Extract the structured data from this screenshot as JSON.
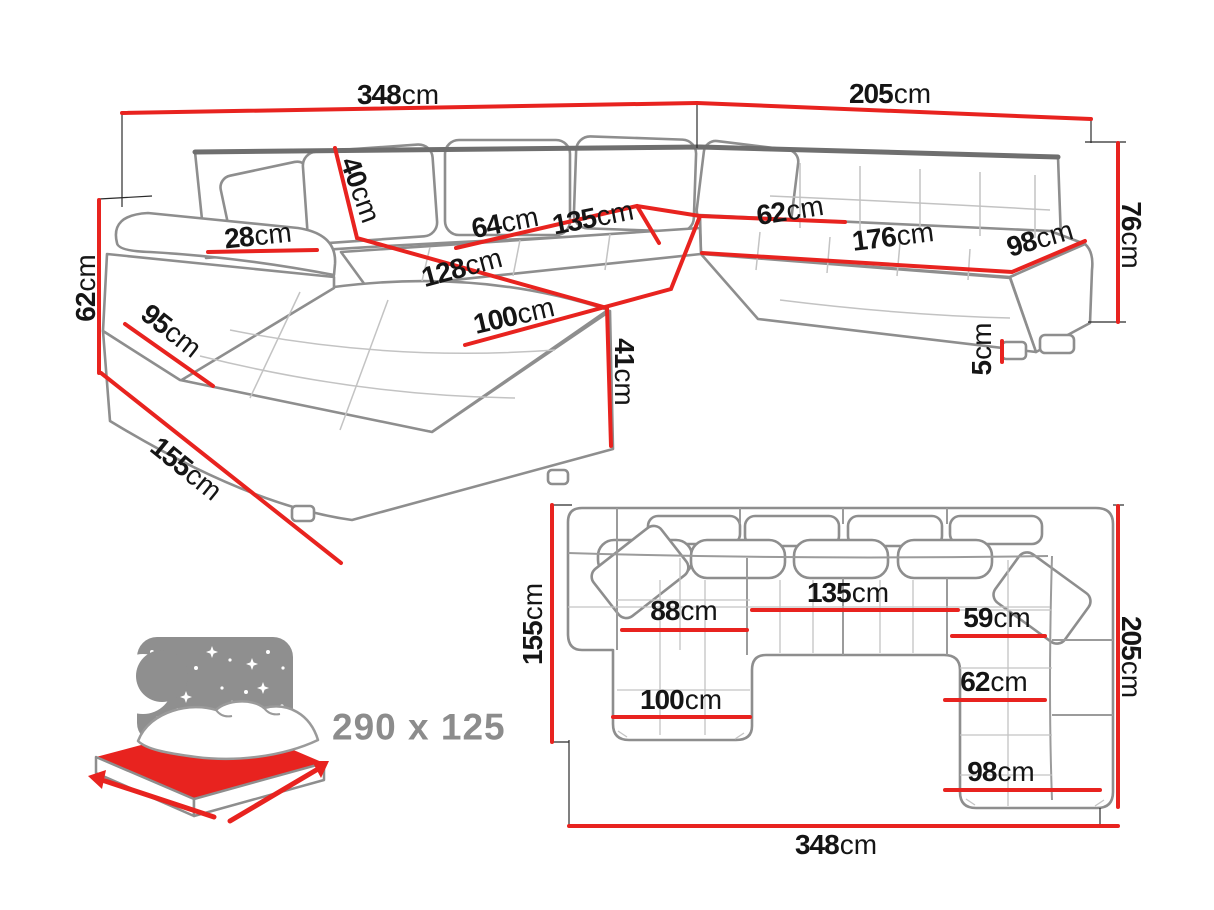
{
  "colors": {
    "accent_red": "#e8231f",
    "sofa_line_gray": "#8e8e8e",
    "sofa_line_dark": "#6f6f6f",
    "tuft_line_gray": "#c3c3c3",
    "text_black": "#151515",
    "muted_gray": "#8c8c8c",
    "background": "#ffffff"
  },
  "perspective_view": {
    "dimensions": [
      {
        "id": "total-width-top",
        "value": "348",
        "unit": "cm"
      },
      {
        "id": "right-side-width-top",
        "value": "205",
        "unit": "cm"
      },
      {
        "id": "backrest-height",
        "value": "76",
        "unit": "cm"
      },
      {
        "id": "back-cushion-height",
        "value": "40",
        "unit": "cm"
      },
      {
        "id": "armrest-width",
        "value": "28",
        "unit": "cm"
      },
      {
        "id": "arm-side-height",
        "value": "62",
        "unit": "cm"
      },
      {
        "id": "chaise-side-95",
        "value": "95",
        "unit": "cm"
      },
      {
        "id": "chaise-depth-155",
        "value": "155",
        "unit": "cm"
      },
      {
        "id": "seat-depth-64",
        "value": "64",
        "unit": "cm"
      },
      {
        "id": "seat-length-135",
        "value": "135",
        "unit": "cm"
      },
      {
        "id": "corner-seat-62",
        "value": "62",
        "unit": "cm"
      },
      {
        "id": "right-seat-length-176",
        "value": "176",
        "unit": "cm"
      },
      {
        "id": "right-arm-98",
        "value": "98",
        "unit": "cm"
      },
      {
        "id": "chaise-length-128",
        "value": "128",
        "unit": "cm"
      },
      {
        "id": "chaise-width-100",
        "value": "100",
        "unit": "cm"
      },
      {
        "id": "seat-height-41",
        "value": "41",
        "unit": "cm"
      },
      {
        "id": "leg-height-5",
        "value": "5",
        "unit": "cm"
      }
    ]
  },
  "plan_view": {
    "dimensions": [
      {
        "id": "chaise-depth-155",
        "value": "155",
        "unit": "cm"
      },
      {
        "id": "chaise-seat-88",
        "value": "88",
        "unit": "cm"
      },
      {
        "id": "middle-seat-135",
        "value": "135",
        "unit": "cm"
      },
      {
        "id": "right-seat-59",
        "value": "59",
        "unit": "cm"
      },
      {
        "id": "right-depth-205",
        "value": "205",
        "unit": "cm"
      },
      {
        "id": "chaise-width-100",
        "value": "100",
        "unit": "cm"
      },
      {
        "id": "right-seat-62",
        "value": "62",
        "unit": "cm"
      },
      {
        "id": "right-width-98",
        "value": "98",
        "unit": "cm"
      },
      {
        "id": "total-width-348",
        "value": "348",
        "unit": "cm"
      }
    ]
  },
  "sleeping_area": {
    "label": "290 x 125"
  }
}
